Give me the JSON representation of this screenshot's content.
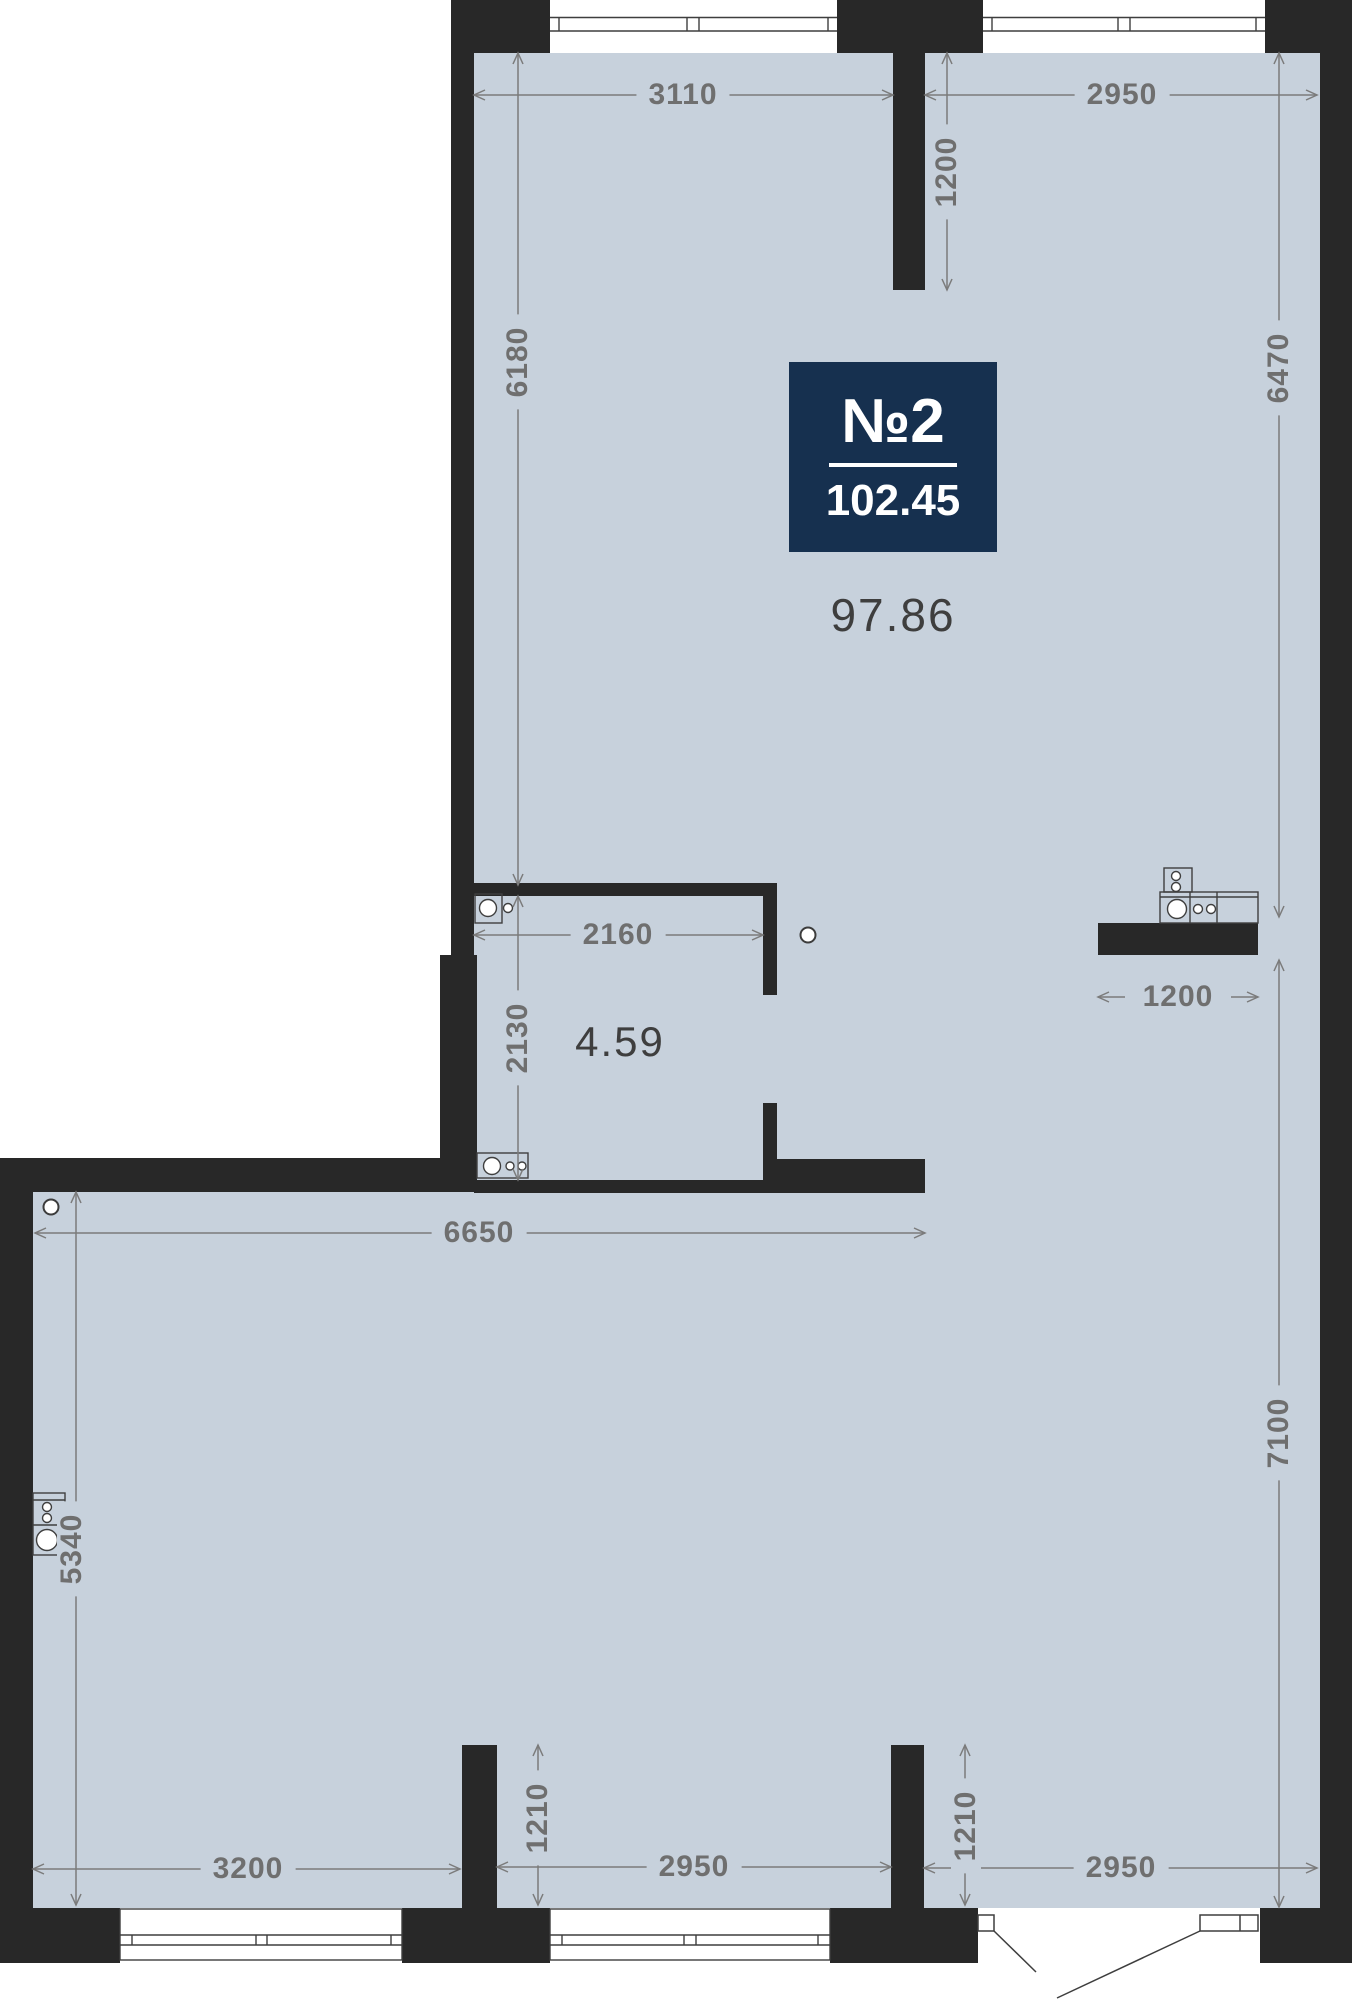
{
  "unit_badge": {
    "number": "№2",
    "total_area": "102.45"
  },
  "rooms": {
    "main_area": "97.86",
    "hall_area": "4.59"
  },
  "dimensions": {
    "top_left_width": "3110",
    "top_niche_depth": "1200",
    "top_right_width": "2950",
    "upper_left_height": "6180",
    "upper_right_height": "6470",
    "hall_width": "2160",
    "hall_height": "2130",
    "kitchen_counter_width": "1200",
    "lower_top_width": "6650",
    "lower_right_height": "7100",
    "lower_left_height": "5340",
    "bottom_left_width": "3200",
    "bottom_niche_left": "1210",
    "bottom_mid_width": "2950",
    "bottom_niche_right": "1210",
    "bottom_right_width": "2950"
  },
  "colors": {
    "floor": "#c7d1dc",
    "wall": "#282828",
    "badge": "#16304f",
    "dimension_text": "#6f6f6f",
    "dimension_line": "#7b7b7b",
    "area_text": "#3e3e3e",
    "fixture_stroke": "#3f3f3f"
  }
}
